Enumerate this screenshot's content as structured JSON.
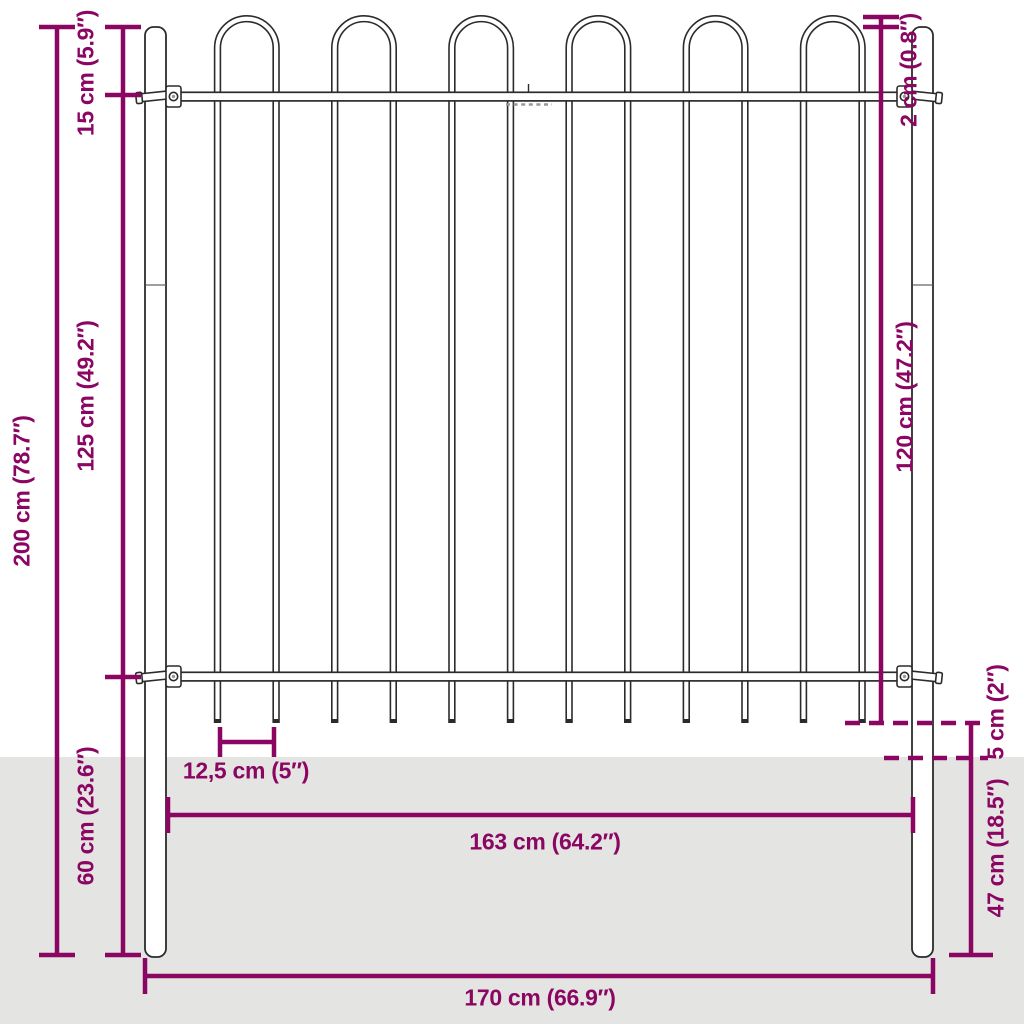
{
  "canvas": {
    "width": 1024,
    "height": 1024,
    "background": "#ffffff",
    "ground_color": "#e4e4e2",
    "accent_color": "#8b0663",
    "line_color": "#2b2b2b"
  },
  "diagram": {
    "type": "product-dimension-diagram",
    "subject": "garden-fence-panel-with-hoop-top-and-round-posts"
  },
  "measurements": {
    "total_height": {
      "label": "200 cm (78.7″)",
      "cm": 200,
      "inches": 78.7
    },
    "top_offset": {
      "label": "15 cm (5.9″)",
      "cm": 15,
      "inches": 5.9
    },
    "rail_spacing": {
      "label": "125 cm (49.2″)",
      "cm": 125,
      "inches": 49.2
    },
    "post_depth_left": {
      "label": "60 cm (23.6″)",
      "cm": 60,
      "inches": 23.6
    },
    "hoop_above_post": {
      "label": "2 cm (0.8″)",
      "cm": 2,
      "inches": 0.8
    },
    "panel_height": {
      "label": "120 cm (47.2″)",
      "cm": 120,
      "inches": 47.2
    },
    "bar_spacing": {
      "label": "12,5 cm (5″)",
      "cm": 12.5,
      "inches": 5
    },
    "ground_gap": {
      "label": "5 cm (2″)",
      "cm": 5,
      "inches": 2
    },
    "post_underground": {
      "label": "47 cm (18.5″)",
      "cm": 47,
      "inches": 18.5
    },
    "panel_width": {
      "label": "163 cm (64.2″)",
      "cm": 163,
      "inches": 64.2
    },
    "total_width": {
      "label": "170 cm (66.9″)",
      "cm": 170,
      "inches": 66.9
    }
  }
}
